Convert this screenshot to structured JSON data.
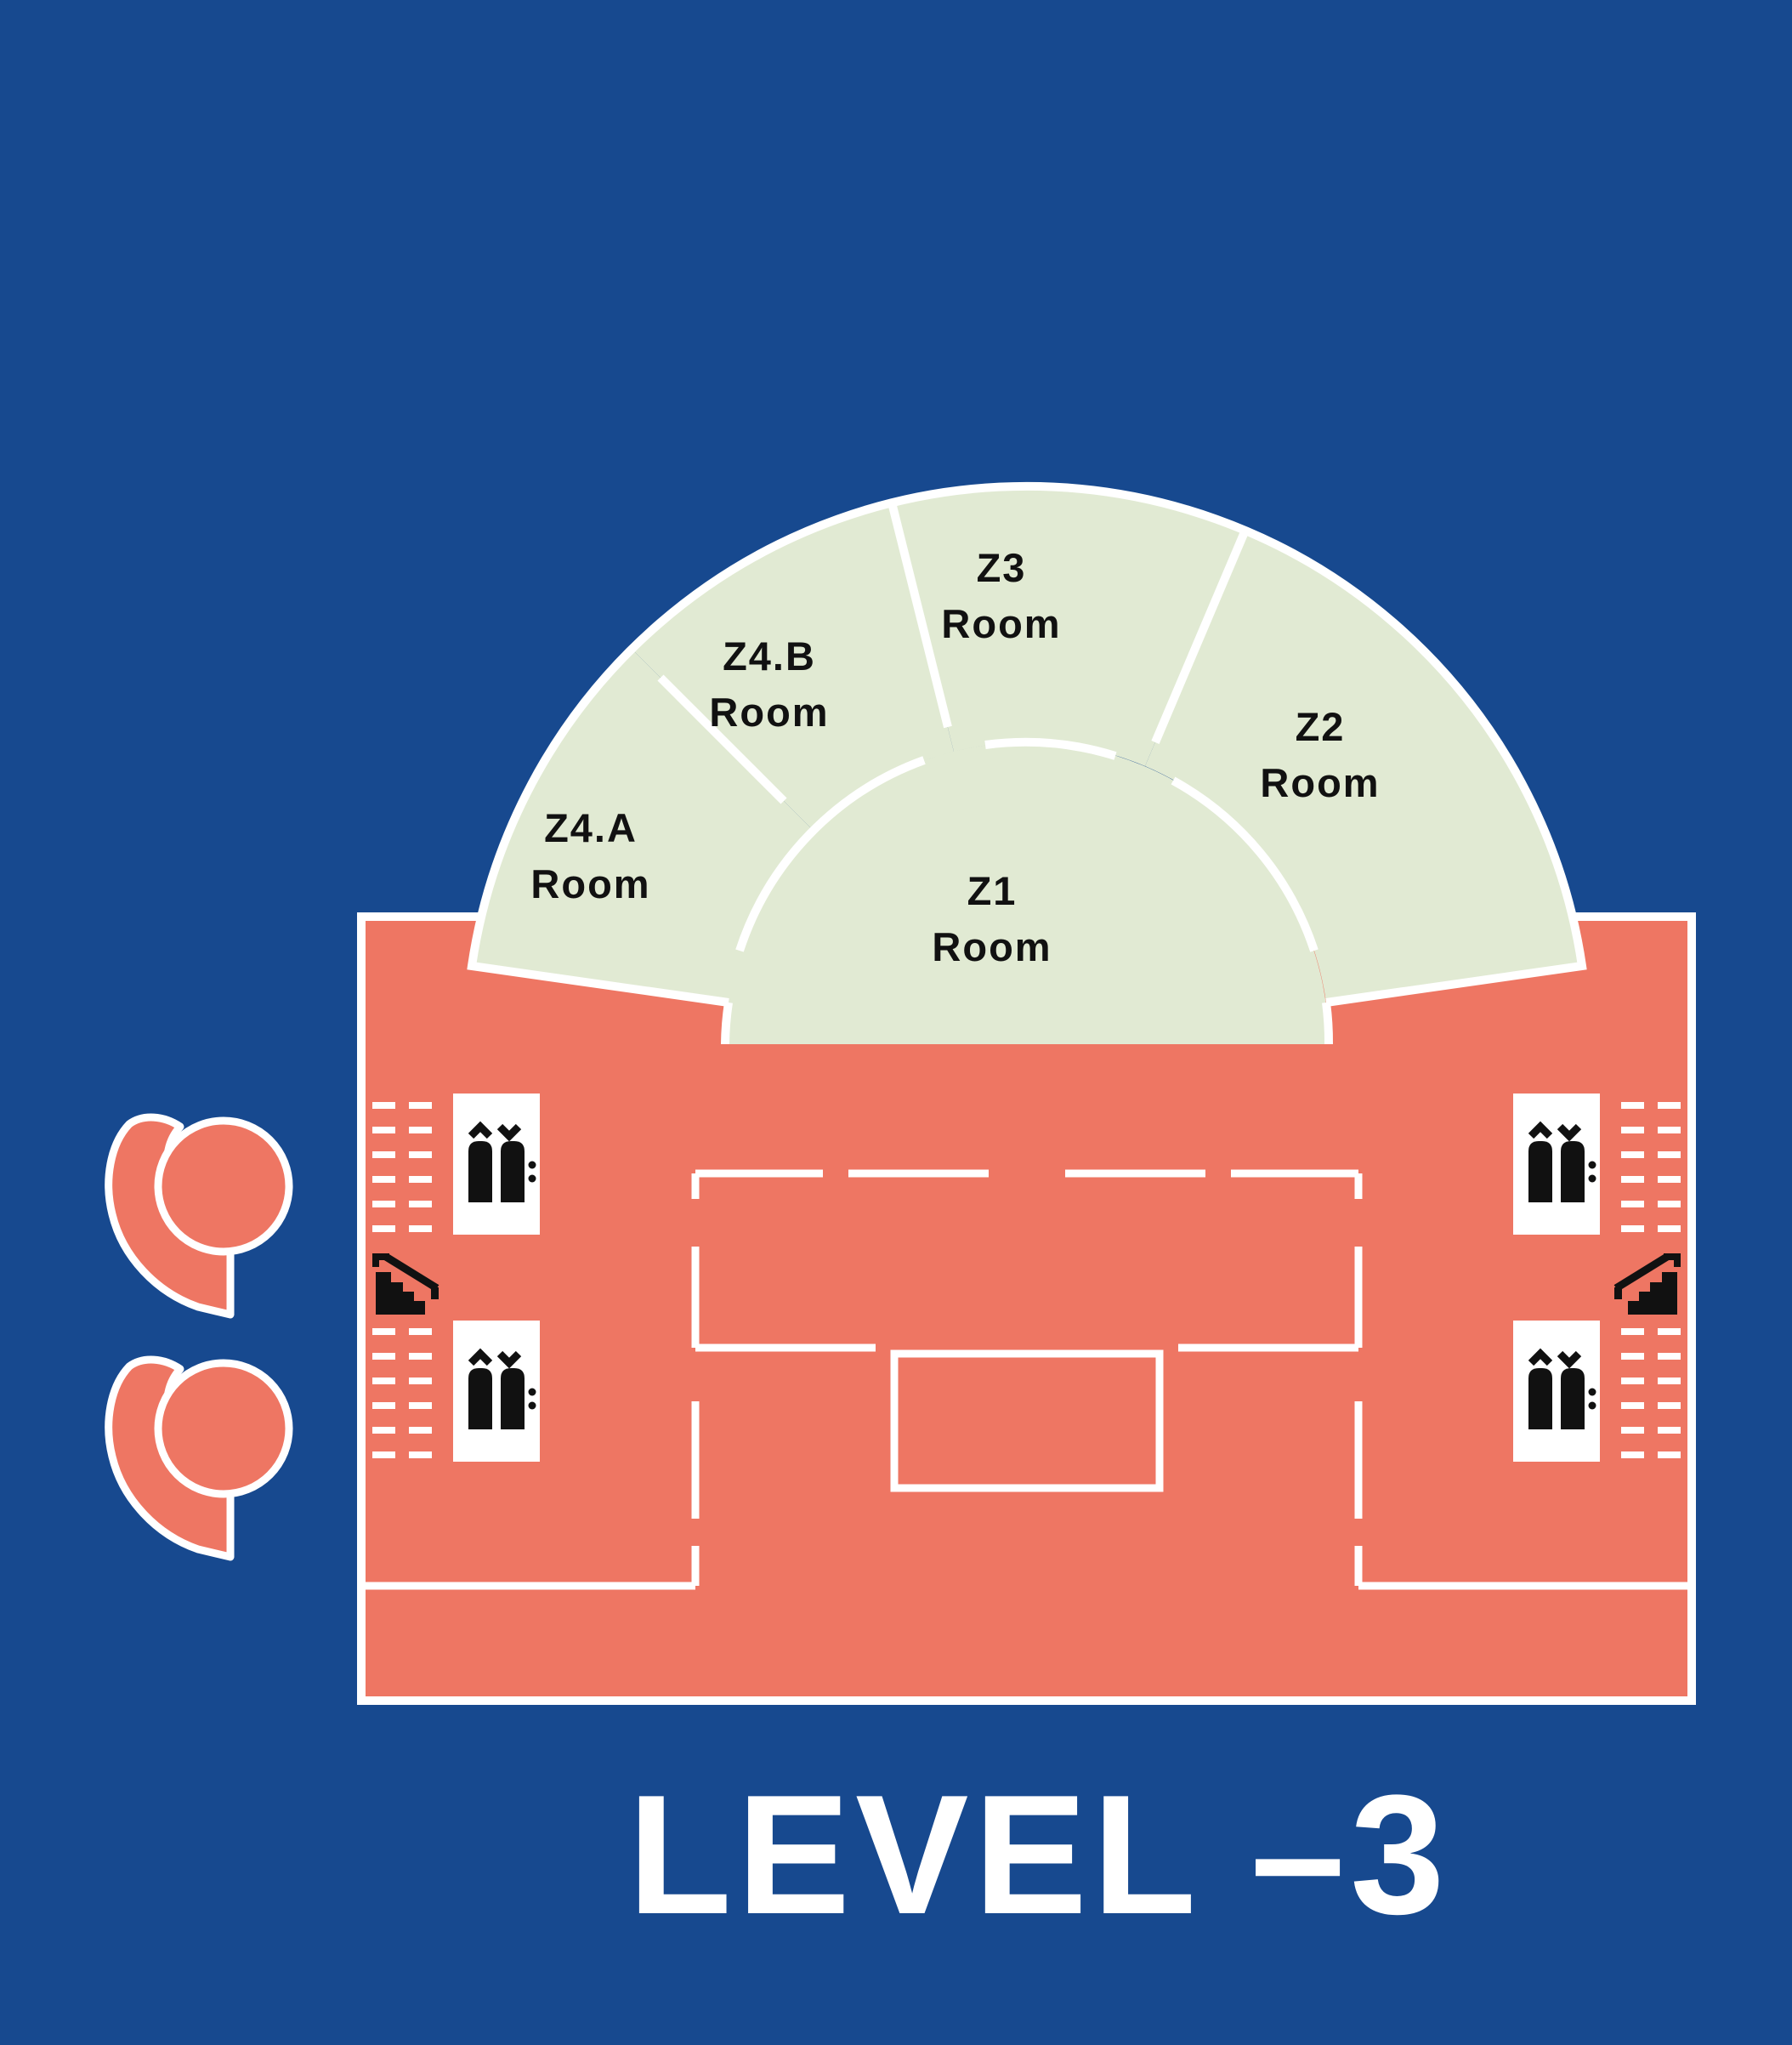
{
  "title": {
    "text": "LEVEL –3"
  },
  "colors": {
    "background_blue": "#17498f",
    "building_salmon": "#ee7663",
    "rooms_green": "#e1ead3",
    "outline_white": "#ffffff",
    "icon_black": "#111111"
  },
  "rooms": {
    "z4a": {
      "code": "Z4.A",
      "suffix": "Room"
    },
    "z4b": {
      "code": "Z4.B",
      "suffix": "Room"
    },
    "z3": {
      "code": "Z3",
      "suffix": "Room"
    },
    "z2": {
      "code": "Z2",
      "suffix": "Room"
    },
    "z1": {
      "code": "Z1",
      "suffix": "Room"
    }
  },
  "icons": {
    "elevator_count": 4,
    "stairs_count": 2,
    "elevator": "elevator-icon",
    "stairs": "stairs-icon",
    "logo": "comma-logo-icon"
  }
}
